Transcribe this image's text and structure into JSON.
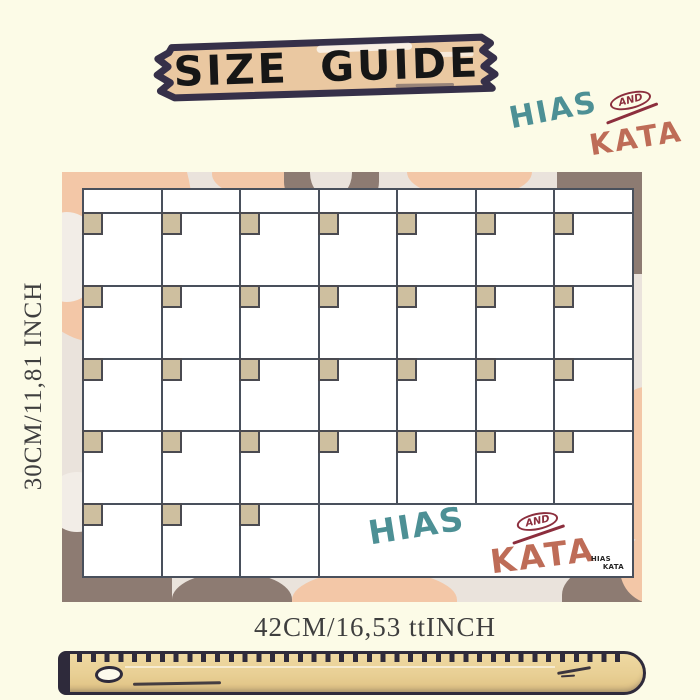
{
  "page": {
    "background": "#FCFBE7"
  },
  "banner": {
    "label": "SIZE GUIDE",
    "fill": "#EAC8A1",
    "outline": "#363049"
  },
  "brand": {
    "hias": "HIAS",
    "and": "AND",
    "kata": "KATA"
  },
  "calendar": {
    "columns": 7,
    "rows": 5,
    "header_row": true,
    "brand_cell_start": 4,
    "watermark": {
      "hias": "HIAS",
      "and": "AND",
      "kata": "KATA"
    },
    "corner_mark": {
      "line1": "HIAS",
      "line2": "KATA"
    }
  },
  "dimensions": {
    "height_label": "30CM/11,81 INCH",
    "width_label": "42CM/16,53 ttINCH"
  },
  "colors": {
    "page-bg": "#FCFBE7",
    "ink": "#363049",
    "banner-fill": "#EAC8A1",
    "banner-text": "#161616",
    "frame-base": "#EAE3DC",
    "blob-peach": "#F3C7A7",
    "blob-brown": "#8D7B72",
    "blob-cream": "#F2EDE7",
    "grid-bg": "#FFFFFF",
    "grid-line": "#49505C",
    "tab-fill": "#CEBF9F",
    "tab-line": "#4A4A50",
    "teal": "#4D9095",
    "brand-red": "#8C2E3D",
    "terracotta": "#BE6C57",
    "dim-text": "#3E3E3E",
    "ruler-fill": "#E9D095",
    "ruler-line": "#2E2A3B"
  }
}
